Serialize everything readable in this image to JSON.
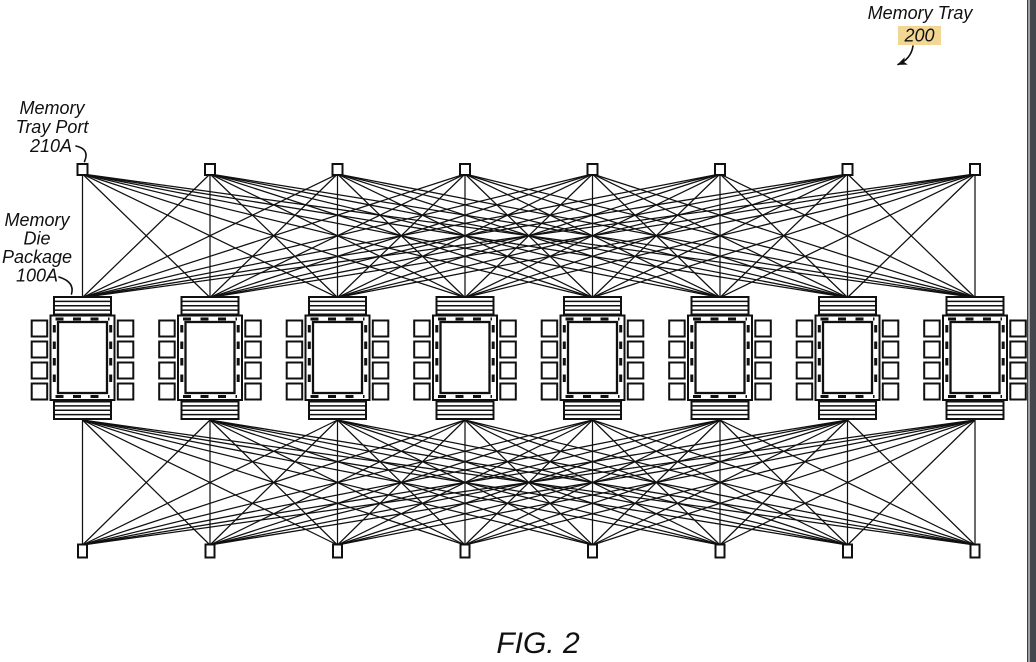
{
  "figure": {
    "caption": "FIG. 2"
  },
  "labels": {
    "memory_tray": {
      "name": "Memory Tray",
      "ref": "200"
    },
    "memory_tray_port": {
      "line1": "Memory",
      "line2": "Tray Port",
      "ref": "210A"
    },
    "memory_die_package": {
      "line1": "Memory",
      "line2": "Die",
      "line3": "Package",
      "ref": "100A"
    }
  },
  "diagram": {
    "package_count": 8,
    "top_port_count": 8,
    "bottom_port_count": 8,
    "topology": "every tray port connects to every memory die package (full mesh, top and bottom)"
  },
  "colors": {
    "ink": "#101010",
    "ref_number": "#b5790b",
    "ref_highlight": "#f2d794",
    "page_edge_bar": "#43464b",
    "page_edge_line": "#3a3d42",
    "background": "#ffffff"
  }
}
